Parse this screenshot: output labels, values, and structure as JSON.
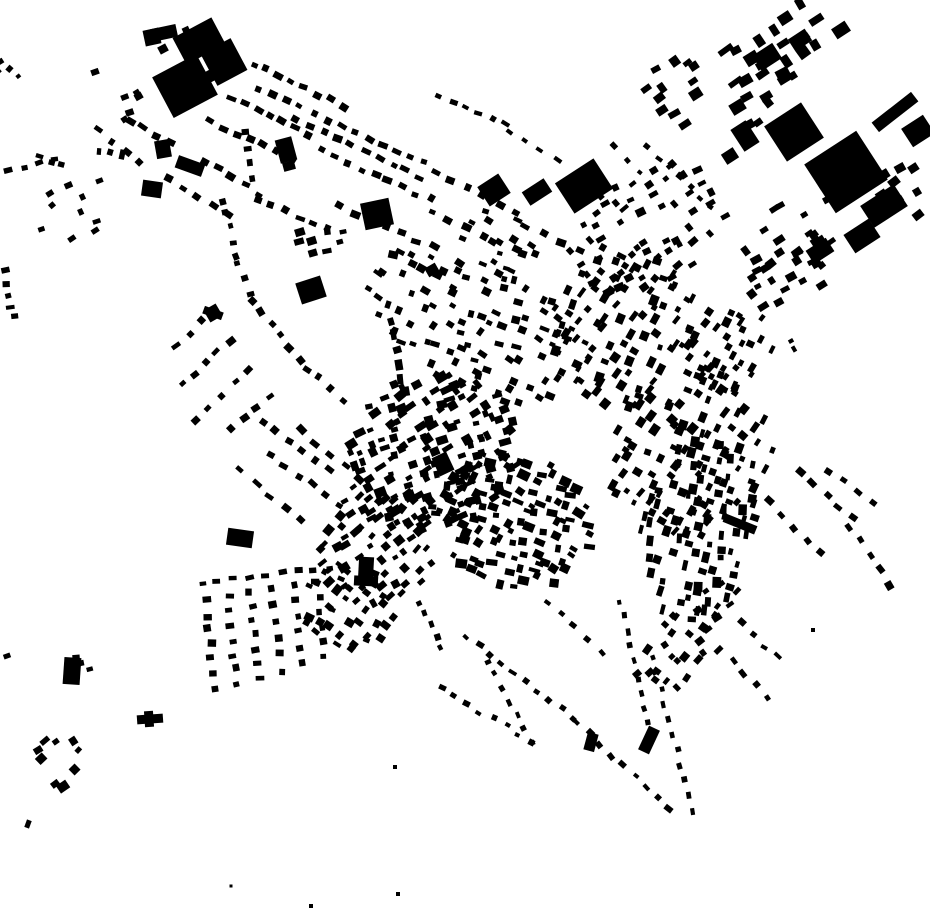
{
  "map": {
    "title": "Figure-ground map of building footprints",
    "width": 930,
    "height": 924,
    "background_color": "#ffffff",
    "building_color": "#000000"
  },
  "buildings": {
    "large": [
      [
        152,
        37,
        16,
        16,
        -12
      ],
      [
        164,
        33,
        26,
        13,
        -12
      ],
      [
        199,
        41,
        44,
        30,
        -28
      ],
      [
        224,
        62,
        34,
        36,
        -28
      ],
      [
        185,
        86,
        50,
        46,
        -28
      ],
      [
        214,
        74,
        16,
        12,
        -28
      ],
      [
        163,
        49,
        9,
        8,
        -28
      ],
      [
        163,
        149,
        15,
        18,
        -10
      ],
      [
        190,
        166,
        28,
        13,
        20
      ],
      [
        152,
        189,
        20,
        16,
        8
      ],
      [
        584,
        186,
        46,
        36,
        -33
      ],
      [
        494,
        190,
        25,
        23,
        -33
      ],
      [
        537,
        192,
        26,
        16,
        -33
      ],
      [
        377,
        214,
        29,
        27,
        -12
      ],
      [
        311,
        290,
        26,
        22,
        -18
      ],
      [
        286,
        150,
        17,
        24,
        -15
      ],
      [
        289,
        166,
        12,
        9,
        -15
      ],
      [
        794,
        132,
        44,
        42,
        -33
      ],
      [
        846,
        172,
        62,
        58,
        -33
      ],
      [
        884,
        206,
        40,
        26,
        -33
      ],
      [
        895,
        112,
        50,
        12,
        -38
      ],
      [
        918,
        131,
        26,
        22,
        -33
      ],
      [
        862,
        236,
        30,
        22,
        -33
      ],
      [
        820,
        251,
        24,
        16,
        -33
      ],
      [
        767,
        57,
        24,
        18,
        -33
      ],
      [
        800,
        40,
        20,
        14,
        -33
      ],
      [
        841,
        30,
        16,
        12,
        -33
      ],
      [
        745,
        136,
        18,
        26,
        -33
      ],
      [
        730,
        156,
        14,
        12,
        -33
      ],
      [
        213,
        313,
        14,
        14,
        -30
      ],
      [
        213,
        313,
        20,
        8,
        20
      ],
      [
        366,
        569,
        15,
        24,
        3
      ],
      [
        366,
        581,
        24,
        10,
        3
      ],
      [
        240,
        538,
        26,
        17,
        8
      ],
      [
        72,
        671,
        17,
        27,
        4
      ],
      [
        150,
        719,
        26,
        9,
        -4
      ],
      [
        149,
        719,
        9,
        16,
        -4
      ],
      [
        443,
        464,
        16,
        20,
        -25
      ],
      [
        649,
        740,
        12,
        26,
        25
      ],
      [
        591,
        742,
        11,
        18,
        15
      ],
      [
        740,
        524,
        34,
        9,
        22
      ],
      [
        7,
        656,
        7,
        5,
        -20
      ],
      [
        28,
        824,
        5,
        8,
        20
      ],
      [
        231,
        886,
        3,
        3,
        0
      ],
      [
        311,
        906,
        4,
        4,
        0
      ],
      [
        398,
        894,
        4,
        4,
        0
      ],
      [
        395,
        767,
        4,
        4,
        0
      ],
      [
        813,
        630,
        4,
        4,
        0
      ],
      [
        791,
        341,
        5,
        4,
        -30
      ],
      [
        794,
        349,
        4,
        6,
        -30
      ],
      [
        95,
        72,
        8,
        6,
        -20
      ],
      [
        186,
        30,
        7,
        6,
        -25
      ],
      [
        432,
        270,
        12,
        10,
        -30
      ]
    ],
    "rows": [
      [
        10,
        172,
        55,
        160,
        4,
        7,
        5
      ],
      [
        100,
        150,
        122,
        154,
        3,
        5,
        8
      ],
      [
        253,
        64,
        342,
        106,
        8,
        8,
        6
      ],
      [
        258,
        88,
        424,
        163,
        13,
        8,
        6
      ],
      [
        233,
        97,
        308,
        134,
        7,
        8,
        6
      ],
      [
        210,
        121,
        290,
        158,
        7,
        8,
        6
      ],
      [
        296,
        119,
        420,
        177,
        10,
        8,
        6
      ],
      [
        320,
        151,
        430,
        200,
        9,
        8,
        6
      ],
      [
        436,
        172,
        515,
        212,
        6,
        8,
        6
      ],
      [
        246,
        133,
        252,
        178,
        4,
        6,
        7
      ],
      [
        203,
        161,
        258,
        194,
        5,
        8,
        6
      ],
      [
        168,
        179,
        228,
        214,
        5,
        8,
        6
      ],
      [
        130,
        120,
        172,
        143,
        4,
        8,
        6
      ],
      [
        100,
        130,
        138,
        163,
        4,
        7,
        6
      ],
      [
        258,
        199,
        328,
        230,
        6,
        8,
        6
      ],
      [
        340,
        207,
        416,
        241,
        6,
        8,
        6
      ],
      [
        432,
        212,
        516,
        250,
        6,
        8,
        6
      ],
      [
        524,
        226,
        598,
        260,
        5,
        8,
        6
      ],
      [
        604,
        246,
        688,
        300,
        6,
        8,
        6
      ],
      [
        222,
        200,
        236,
        255,
        5,
        6,
        6
      ],
      [
        238,
        262,
        250,
        295,
        3,
        6,
        6
      ],
      [
        253,
        301,
        299,
        359,
        6,
        7,
        6
      ],
      [
        306,
        368,
        344,
        399,
        4,
        7,
        6
      ],
      [
        176,
        344,
        214,
        311,
        4,
        8,
        6
      ],
      [
        181,
        384,
        229,
        341,
        5,
        8,
        6
      ],
      [
        196,
        419,
        249,
        371,
        5,
        8,
        6
      ],
      [
        231,
        429,
        269,
        396,
        4,
        8,
        6
      ],
      [
        262,
        421,
        330,
        469,
        6,
        8,
        6
      ],
      [
        271,
        456,
        339,
        504,
        6,
        8,
        6
      ],
      [
        241,
        471,
        299,
        519,
        5,
        8,
        6
      ],
      [
        301,
        431,
        359,
        479,
        5,
        8,
        6
      ],
      [
        800,
        472,
        853,
        519,
        5,
        8,
        6
      ],
      [
        850,
        527,
        889,
        584,
        5,
        7,
        6
      ],
      [
        771,
        501,
        819,
        553,
        5,
        8,
        6
      ],
      [
        828,
        470,
        872,
        503,
        4,
        8,
        6
      ],
      [
        206,
        601,
        214,
        688,
        7,
        6,
        7
      ],
      [
        228,
        596,
        237,
        684,
        7,
        6,
        7
      ],
      [
        250,
        591,
        259,
        678,
        7,
        6,
        7
      ],
      [
        272,
        588,
        281,
        671,
        6,
        6,
        7
      ],
      [
        294,
        585,
        303,
        664,
        6,
        6,
        7
      ],
      [
        317,
        582,
        325,
        658,
        6,
        6,
        7
      ],
      [
        202,
        582,
        330,
        568,
        9,
        8,
        5
      ],
      [
        467,
        637,
        573,
        717,
        10,
        7,
        5
      ],
      [
        578,
        722,
        668,
        810,
        9,
        7,
        5
      ],
      [
        487,
        661,
        531,
        744,
        7,
        6,
        5
      ],
      [
        441,
        688,
        532,
        742,
        8,
        6,
        5
      ],
      [
        621,
        601,
        651,
        739,
        10,
        6,
        5
      ],
      [
        653,
        656,
        692,
        812,
        11,
        6,
        5
      ],
      [
        546,
        601,
        601,
        652,
        5,
        7,
        5
      ],
      [
        421,
        602,
        441,
        648,
        5,
        6,
        5
      ],
      [
        733,
        661,
        766,
        699,
        4,
        7,
        5
      ],
      [
        753,
        636,
        779,
        656,
        3,
        7,
        5
      ],
      [
        6,
        272,
        14,
        318,
        5,
        5,
        7
      ],
      [
        40,
        158,
        63,
        166,
        3,
        7,
        5
      ],
      [
        648,
        148,
        712,
        208,
        7,
        6,
        5
      ],
      [
        440,
        96,
        504,
        124,
        6,
        7,
        5
      ],
      [
        508,
        130,
        558,
        158,
        4,
        7,
        5
      ],
      [
        614,
        145,
        640,
        172,
        3,
        6,
        5
      ],
      [
        390,
        322,
        404,
        392,
        6,
        9,
        7
      ]
    ],
    "clusters": [
      {
        "cx": 432,
        "cy": 452,
        "rx": 88,
        "ry": 78,
        "n": 140,
        "s": [
          5,
          12
        ],
        "rot": -25,
        "jit": 30,
        "seed": 11
      },
      {
        "cx": 512,
        "cy": 520,
        "rx": 82,
        "ry": 68,
        "n": 110,
        "s": [
          5,
          12
        ],
        "rot": 20,
        "jit": 30,
        "seed": 12
      },
      {
        "cx": 378,
        "cy": 545,
        "rx": 62,
        "ry": 58,
        "n": 60,
        "s": [
          5,
          11
        ],
        "rot": -40,
        "jit": 25,
        "seed": 13
      },
      {
        "cx": 478,
        "cy": 325,
        "rx": 118,
        "ry": 68,
        "n": 100,
        "s": [
          5,
          10
        ],
        "rot": 25,
        "jit": 25,
        "seed": 14
      },
      {
        "cx": 622,
        "cy": 330,
        "rx": 82,
        "ry": 72,
        "n": 78,
        "s": [
          5,
          11
        ],
        "rot": -60,
        "jit": 25,
        "seed": 15
      },
      {
        "cx": 692,
        "cy": 452,
        "rx": 92,
        "ry": 78,
        "n": 92,
        "s": [
          5,
          11
        ],
        "rot": -60,
        "jit": 25,
        "seed": 16
      },
      {
        "cx": 700,
        "cy": 525,
        "rx": 98,
        "ry": 58,
        "n": 80,
        "s": [
          5,
          11
        ],
        "rot": -80,
        "jit": 20,
        "seed": 17
      },
      {
        "cx": 648,
        "cy": 228,
        "rx": 88,
        "ry": 58,
        "n": 56,
        "s": [
          5,
          10
        ],
        "rot": -33,
        "jit": 20,
        "seed": 18
      },
      {
        "cx": 792,
        "cy": 272,
        "rx": 52,
        "ry": 30,
        "n": 20,
        "s": [
          6,
          11
        ],
        "rot": -33,
        "jit": 15,
        "seed": 19
      },
      {
        "cx": 352,
        "cy": 610,
        "rx": 52,
        "ry": 44,
        "n": 34,
        "s": [
          5,
          10
        ],
        "rot": 30,
        "jit": 25,
        "seed": 20
      },
      {
        "cx": 62,
        "cy": 762,
        "rx": 24,
        "ry": 28,
        "n": 9,
        "s": [
          6,
          12
        ],
        "rot": -40,
        "jit": 20,
        "seed": 21
      },
      {
        "cx": 84,
        "cy": 672,
        "rx": 20,
        "ry": 18,
        "n": 4,
        "s": [
          5,
          8
        ],
        "rot": -10,
        "jit": 20,
        "seed": 22
      },
      {
        "cx": 692,
        "cy": 640,
        "rx": 72,
        "ry": 36,
        "n": 32,
        "s": [
          5,
          10
        ],
        "rot": -45,
        "jit": 25,
        "seed": 23
      },
      {
        "cx": 80,
        "cy": 205,
        "rx": 46,
        "ry": 30,
        "n": 10,
        "s": [
          5,
          8
        ],
        "rot": -30,
        "jit": 30,
        "seed": 24
      },
      {
        "cx": 8,
        "cy": 68,
        "rx": 10,
        "ry": 16,
        "n": 4,
        "s": [
          4,
          7
        ],
        "rot": -40,
        "jit": 20,
        "seed": 25
      },
      {
        "cx": 132,
        "cy": 110,
        "rx": 22,
        "ry": 18,
        "n": 5,
        "s": [
          6,
          9
        ],
        "rot": -25,
        "jit": 20,
        "seed": 26
      },
      {
        "cx": 728,
        "cy": 352,
        "rx": 52,
        "ry": 46,
        "n": 36,
        "s": [
          5,
          10
        ],
        "rot": -60,
        "jit": 20,
        "seed": 27
      },
      {
        "cx": 775,
        "cy": 50,
        "rx": 66,
        "ry": 38,
        "n": 20,
        "s": [
          7,
          16
        ],
        "rot": -33,
        "jit": 10,
        "seed": 28
      },
      {
        "cx": 672,
        "cy": 94,
        "rx": 40,
        "ry": 42,
        "n": 12,
        "s": [
          6,
          13
        ],
        "rot": -33,
        "jit": 12,
        "seed": 29
      },
      {
        "cx": 752,
        "cy": 110,
        "rx": 32,
        "ry": 26,
        "n": 8,
        "s": [
          8,
          15
        ],
        "rot": -33,
        "jit": 10,
        "seed": 30
      },
      {
        "cx": 800,
        "cy": 225,
        "rx": 75,
        "ry": 30,
        "n": 18,
        "s": [
          6,
          12
        ],
        "rot": -33,
        "jit": 10,
        "seed": 31
      },
      {
        "cx": 903,
        "cy": 182,
        "rx": 26,
        "ry": 38,
        "n": 8,
        "s": [
          6,
          12
        ],
        "rot": -33,
        "jit": 10,
        "seed": 32
      },
      {
        "cx": 505,
        "cy": 245,
        "rx": 55,
        "ry": 30,
        "n": 13,
        "s": [
          5,
          9
        ],
        "rot": 25,
        "jit": 20,
        "seed": 33
      },
      {
        "cx": 320,
        "cy": 246,
        "rx": 30,
        "ry": 22,
        "n": 8,
        "s": [
          5,
          10
        ],
        "rot": -15,
        "jit": 20,
        "seed": 34
      }
    ]
  }
}
